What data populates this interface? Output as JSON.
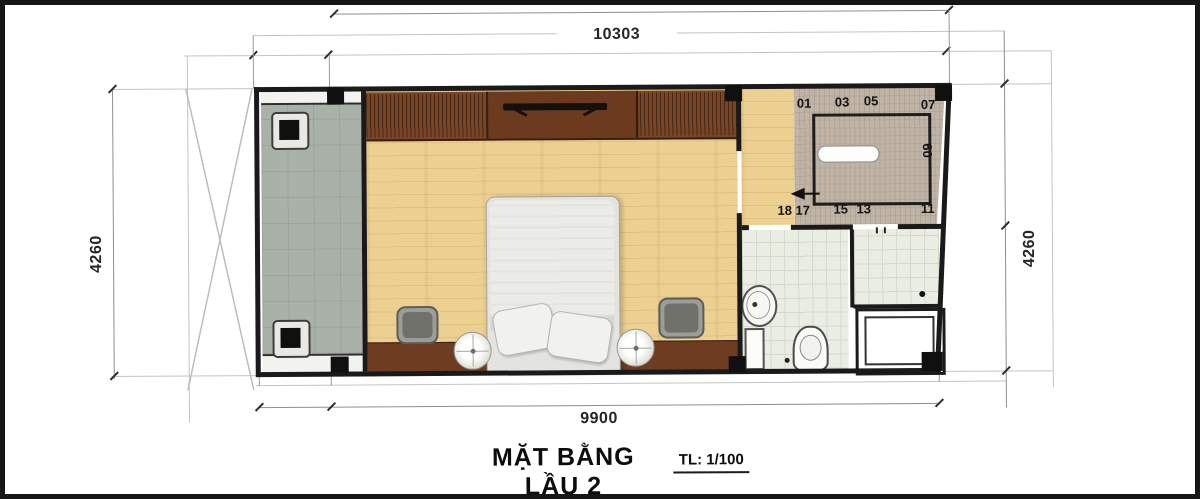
{
  "title": {
    "main": "MẶT BẰNG LẦU 2",
    "scale": "TL: 1/100"
  },
  "dims": {
    "top": "10303",
    "bottom": "9900",
    "left": "4260",
    "right": "4260"
  },
  "stairs": {
    "s01": "01",
    "s03": "03",
    "s05": "05",
    "s07": "07",
    "s09": "09",
    "s11": "11",
    "s13": "13",
    "s15": "15",
    "s17": "17",
    "s18": "18"
  },
  "colors": {
    "wood_floor": "#ecd092",
    "balcony_floor": "#a9b1a8",
    "wardrobe": "#7a4527",
    "bed_platform": "#6e3c20",
    "stair_surface": "#bfb4a5",
    "bathroom_tile": "#eaede3",
    "wall": "#1a1a1a"
  }
}
